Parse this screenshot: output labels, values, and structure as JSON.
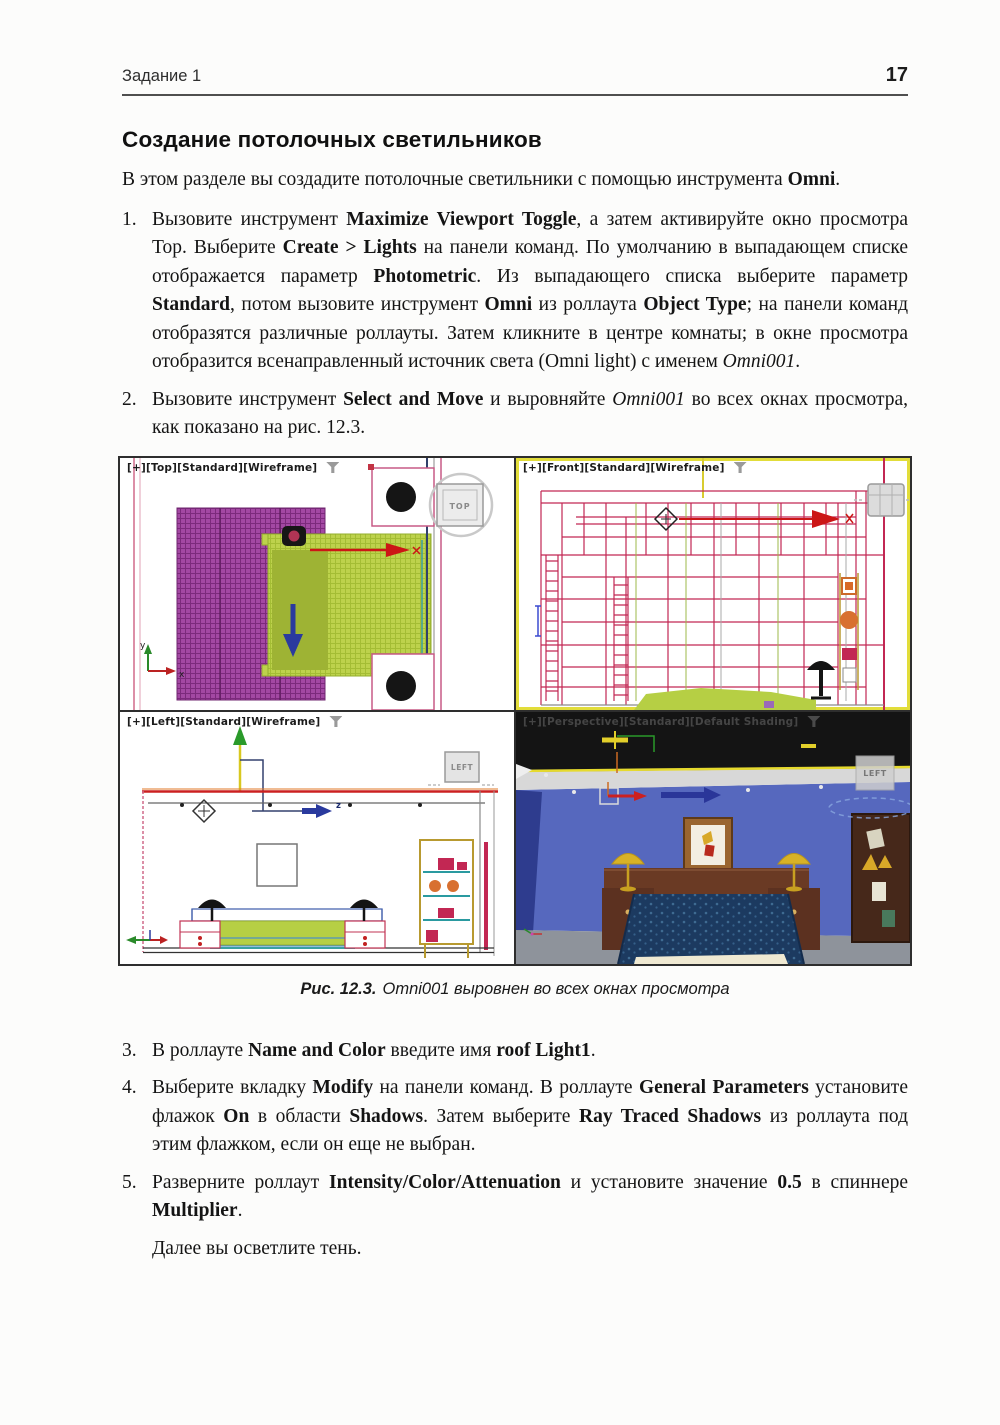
{
  "header": {
    "section": "Задание 1",
    "page_number": "17"
  },
  "title": "Создание потолочных светильников",
  "intro_segments": [
    {
      "t": "В этом разделе вы создадите потолочные светильники с помощью инструмента "
    },
    {
      "t": "Omni",
      "b": true
    },
    {
      "t": "."
    }
  ],
  "steps": [
    {
      "num": "1.",
      "segments": [
        {
          "t": "Вызовите инструмент "
        },
        {
          "t": "Maximize Viewport Toggle",
          "b": true
        },
        {
          "t": ", а затем активируйте окно просмотра Top. Выберите "
        },
        {
          "t": "Create > Lights",
          "b": true
        },
        {
          "t": " на панели команд. По умолчанию в выпадающем списке отображается параметр "
        },
        {
          "t": "Photometric",
          "b": true
        },
        {
          "t": ". Из выпадающего списка выберите параметр "
        },
        {
          "t": "Standard",
          "b": true
        },
        {
          "t": ", потом вызовите инструмент "
        },
        {
          "t": "Omni",
          "b": true
        },
        {
          "t": " из роллаута "
        },
        {
          "t": "Object Type",
          "b": true
        },
        {
          "t": "; на панели команд отобразятся различные роллауты. Затем кликните в центре комнаты; в окне просмотра отобразится всенаправленный источник света (Omni light) с именем "
        },
        {
          "t": "Omni001",
          "i": true
        },
        {
          "t": "."
        }
      ]
    },
    {
      "num": "2.",
      "segments": [
        {
          "t": "Вызовите инструмент "
        },
        {
          "t": "Select and Move",
          "b": true
        },
        {
          "t": " и выровняйте "
        },
        {
          "t": "Omni001",
          "i": true
        },
        {
          "t": " во всех окнах просмотра, как показано на рис. 12.3."
        }
      ]
    },
    {
      "num": "3.",
      "segments": [
        {
          "t": "В роллауте "
        },
        {
          "t": "Name and Color",
          "b": true
        },
        {
          "t": " введите имя "
        },
        {
          "t": "roof Light1",
          "b": true
        },
        {
          "t": "."
        }
      ]
    },
    {
      "num": "4.",
      "segments": [
        {
          "t": "Выберите вкладку "
        },
        {
          "t": "Modify",
          "b": true
        },
        {
          "t": " на панели команд. В роллауте "
        },
        {
          "t": "General Parameters",
          "b": true
        },
        {
          "t": " установите флажок "
        },
        {
          "t": "On",
          "b": true
        },
        {
          "t": " в области "
        },
        {
          "t": "Shadows",
          "b": true
        },
        {
          "t": ". Затем выберите "
        },
        {
          "t": "Ray Traced Shadows",
          "b": true
        },
        {
          "t": " из роллаута под этим флажком, если он еще не выбран."
        }
      ]
    },
    {
      "num": "5.",
      "segments": [
        {
          "t": "Разверните роллаут "
        },
        {
          "t": "Intensity/Color/Attenuation",
          "b": true
        },
        {
          "t": " и установите значение "
        },
        {
          "t": "0.5",
          "b": true
        },
        {
          "t": " в спиннере "
        },
        {
          "t": "Multiplier",
          "b": true
        },
        {
          "t": "."
        }
      ]
    }
  ],
  "closing": "Далее вы осветлите тень.",
  "figure": {
    "caption_label": "Рис. 12.3.",
    "caption_text": "Omni001 выровнен во всех окнах просмотра",
    "viewports": {
      "top": {
        "label": "[+][Top][Standard][Wireframe]",
        "viewcube": "TOP"
      },
      "front": {
        "label": "[+][Front][Standard][Wireframe]"
      },
      "left": {
        "label": "[+][Left][Standard][Wireframe]",
        "viewcube": "LEFT"
      },
      "perspective": {
        "label": "[+][Perspective][Standard][Default Shading]",
        "viewcube": "LEFT"
      }
    },
    "axis": {
      "x": "x",
      "y": "y",
      "z": "z"
    }
  },
  "colors": {
    "active_viewport_border": "#e2dd3a",
    "wireframe_red": "#c22753",
    "rug_purple": "#a348a3",
    "bed_green": "#bdd24c",
    "wall_blue": "#5668be",
    "floor_gray": "#8e939b",
    "gizmo_red": "#cc1616",
    "gizmo_blue": "#2a3a9e",
    "gizmo_green": "#2a9a2a",
    "omni_yellow": "#e2cf2a"
  }
}
